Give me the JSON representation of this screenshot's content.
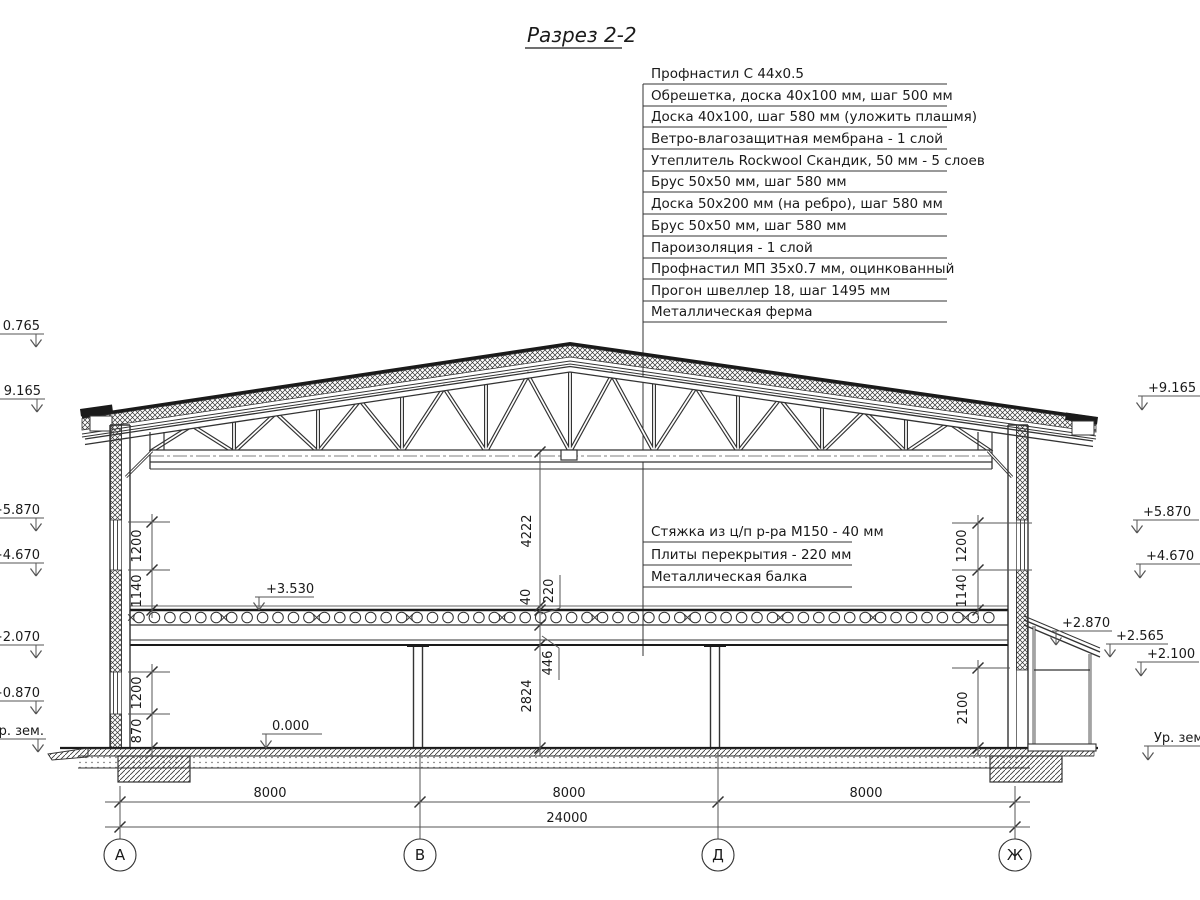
{
  "title": "Разрез 2-2",
  "roof_callouts": [
    "Профнастил С 44х0.5",
    "Обрешетка, доска 40х100 мм, шаг 500 мм",
    "Доска 40х100, шаг 580 мм (уложить плашмя)",
    "Ветро-влагозащитная мембрана - 1 слой",
    "Утеплитель Rockwool Скандик, 50 мм - 5 слоев",
    "Брус 50х50 мм, шаг 580 мм",
    "Доска 50х200 мм (на ребро), шаг 580 мм",
    "Брус 50х50 мм, шаг 580 мм",
    "Пароизоляция - 1 слой",
    "Профнастил МП 35х0.7 мм, оцинкованный",
    "Прогон швеллер 18, шаг 1495 мм",
    "Металлическая ферма"
  ],
  "floor_callouts": [
    "Стяжка из ц/п р-ра М150 - 40 мм",
    "Плиты перекрытия - 220 мм",
    "Металлическая балка"
  ],
  "elevation_marks": {
    "left": [
      "0.765",
      "9.165",
      "+5.870",
      "+4.670",
      "+2.070",
      "+0.870",
      "Ур. зем."
    ],
    "right": [
      "+9.165",
      "+5.870",
      "+4.670",
      "+2.870",
      "+2.565",
      "+2.100",
      "Ур. зем."
    ],
    "interior": [
      "+3.530",
      "0.000"
    ]
  },
  "dimensions": {
    "left_upper": [
      "1200",
      "1140"
    ],
    "left_lower": [
      "1200",
      "870"
    ],
    "right_upper": [
      "1200",
      "1140"
    ],
    "right_lower": [
      "2100"
    ],
    "center": [
      "4222",
      "40",
      "220",
      "446",
      "2824"
    ],
    "spans": [
      "8000",
      "8000",
      "8000"
    ],
    "total": "24000"
  },
  "axes": [
    "А",
    "В",
    "Д",
    "Ж"
  ]
}
